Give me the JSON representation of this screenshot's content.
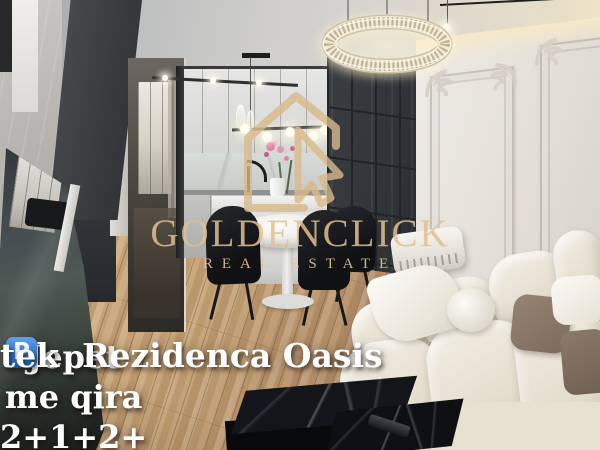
{
  "scene": {
    "description": "Interior photo of a furnished apartment: open white kitchen, round dining table with black chairs, dark panelled accent wall, classical moulded white wall with cove light, ring crystal chandelier, leaning mirror, cream modular sofa with pillows, black marble coffee table on light oak floor"
  },
  "watermark": {
    "logo_icon": "house-with-click-cursor-icon",
    "brand": "GOLDENCLICK",
    "tagline": "REAL ESTATE",
    "gold_color": "#dcbd8f"
  },
  "caption": {
    "line1": "Jepet me qira 2+1+2+",
    "parking_icon": "parking-emoji",
    "parking_symbol": "P",
    "line2": "tek  Rezidenca Oasis",
    "text_color": "#ffffff",
    "parking_bg": "#2b77e0"
  },
  "palette": {
    "floor_wood": "#c2a074",
    "dark_wall": "#35383c",
    "classic_wall": "#e7e3dc",
    "sofa_cream": "#eae5d8",
    "pillow_taupe": "#8a7969",
    "marble_black": "#101216"
  }
}
